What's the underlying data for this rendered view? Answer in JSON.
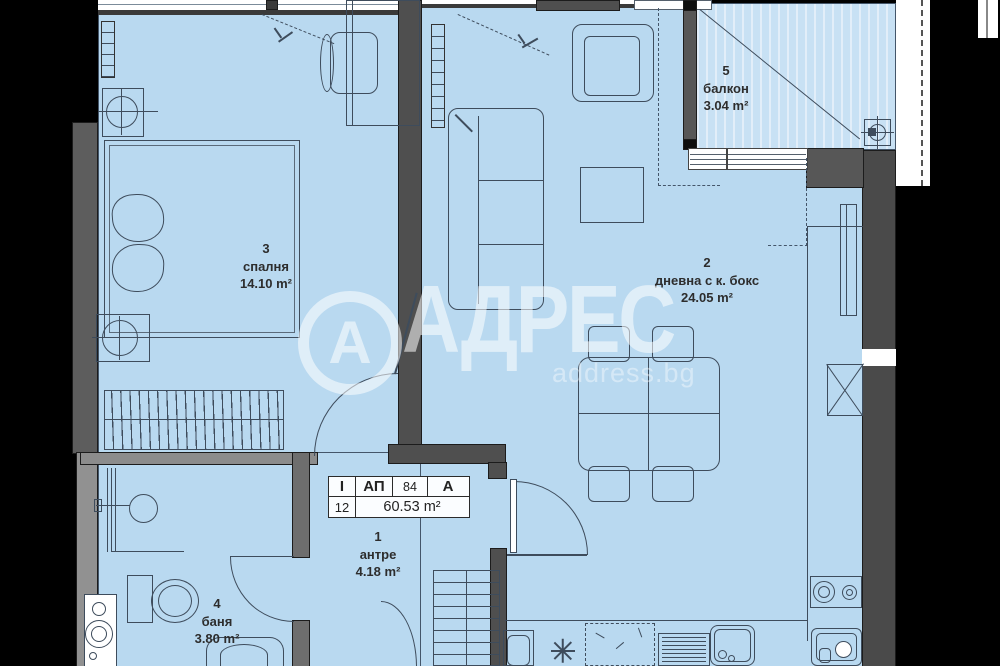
{
  "plan_title": "apartment-floor-plan",
  "rooms": {
    "bedroom": {
      "number": "3",
      "name": "спалня",
      "area": "14.10 m²"
    },
    "living": {
      "number": "2",
      "name": "дневна с к. бокс",
      "area": "24.05 m²"
    },
    "balcony": {
      "number": "5",
      "name": "балкон",
      "area": "3.04 m²"
    },
    "hall": {
      "number": "1",
      "name": "антре",
      "area": "4.18 m²"
    },
    "bath": {
      "number": "4",
      "name": "баня",
      "area": "3.80 m²"
    }
  },
  "info_table": {
    "floor_roman": "I",
    "type_label": "АП",
    "apartment_number": "84",
    "section": "А",
    "floor_number": "12",
    "total_area": "60.53 m²"
  },
  "watermark": {
    "logo_letter": "А",
    "brand": "АДРЕС",
    "website": "address.bg"
  },
  "colors": {
    "background": "#000000",
    "room_fill": "#b9d9f0",
    "balcony_fill": "#c8e1f4",
    "wall_dark": "#4f4f4f",
    "wall_light": "#919191",
    "drawing_line": "#3e4c5c",
    "watermark": "#ffffff"
  }
}
